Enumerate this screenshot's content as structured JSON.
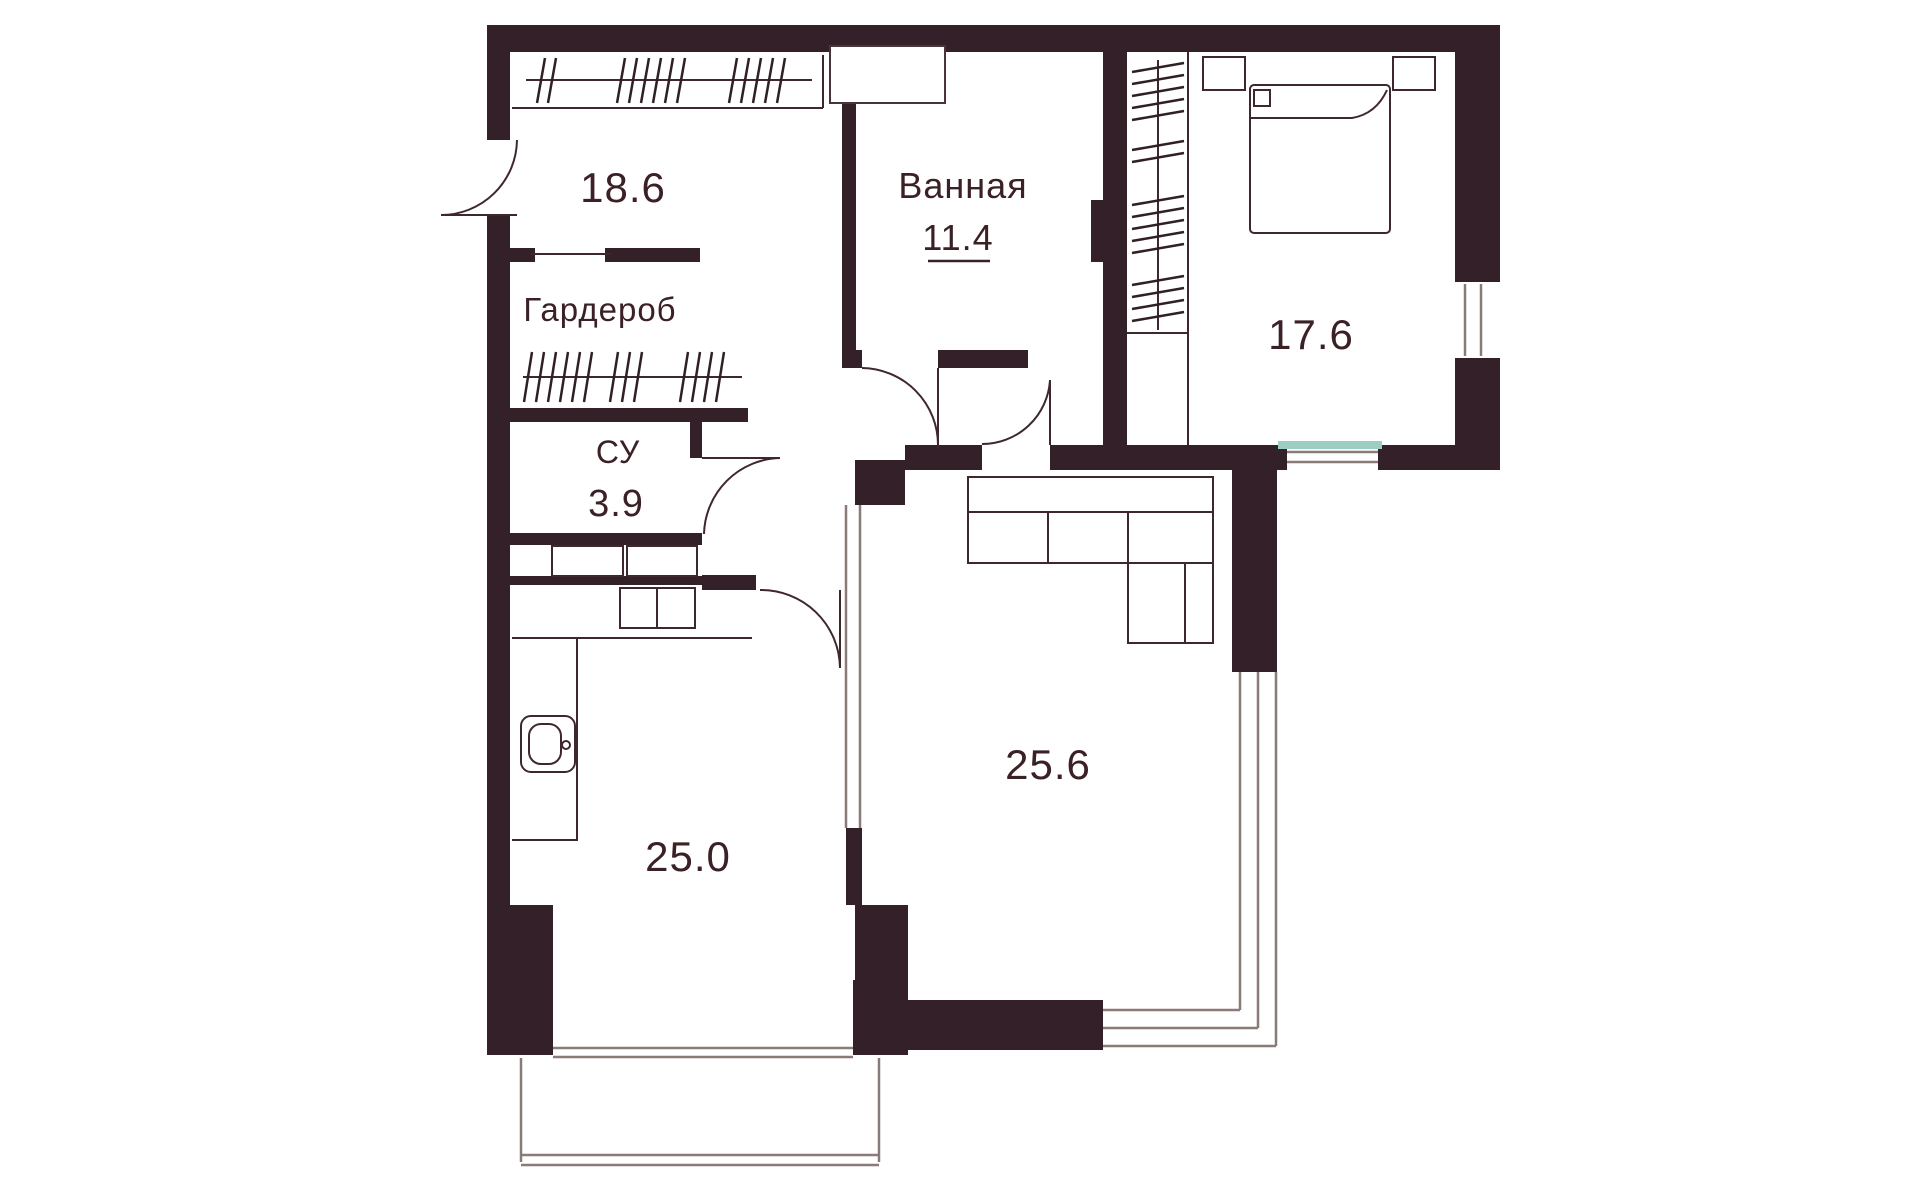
{
  "floor_plan": {
    "background": "#ffffff",
    "colors": {
      "wall": "#332029",
      "label_text": "#3b2125",
      "furniture_line": "#3e282e",
      "window_line": "#8a7b79",
      "window_sill": "#9ccfc4"
    },
    "rooms": [
      {
        "id": "entry-hall",
        "area": "18.6"
      },
      {
        "id": "bathroom",
        "name": "Ванная",
        "area": "11.4"
      },
      {
        "id": "bedroom",
        "area": "17.6"
      },
      {
        "id": "wardrobe",
        "name": "Гардероб"
      },
      {
        "id": "water-closet",
        "name": "СУ",
        "area": "3.9"
      },
      {
        "id": "kitchen",
        "area": "25.0"
      },
      {
        "id": "living-room",
        "area": "25.6"
      }
    ],
    "furniture_icons": [
      "hanger-rail-icon",
      "double-bed-icon",
      "nightstand-icon",
      "corner-sofa-icon",
      "kitchen-counter-icon",
      "sink-icon",
      "washer-icon",
      "cabinet-icon"
    ],
    "opening_icons": [
      "entry-door-arc-icon",
      "bathroom-door-arc-icon",
      "wc-door-arc-icon",
      "kitchen-door-arc-icon",
      "room-door-arc-icon",
      "window-icon",
      "balcony-icon"
    ]
  }
}
